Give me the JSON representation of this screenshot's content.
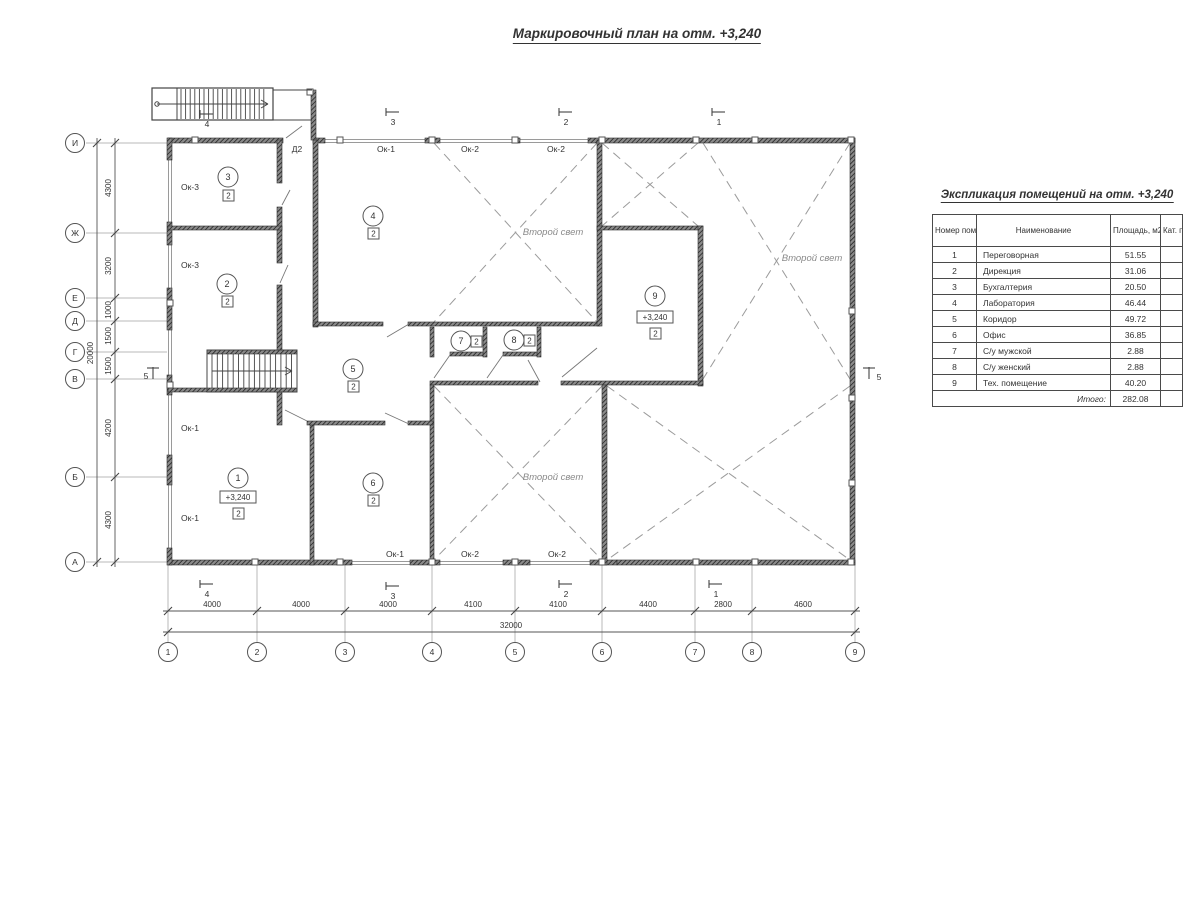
{
  "title": "Маркировочный план на отм. +3,240",
  "table": {
    "title": "Экспликация помещений на отм. +3,240",
    "headers": {
      "num": "Номер помещ.",
      "name": "Наименование",
      "area": "Площадь, м2",
      "cat": "Кат. пом."
    },
    "col_widths": [
      44,
      134,
      50,
      22
    ],
    "rows": [
      {
        "num": "1",
        "name": "Переговорная",
        "area": "51.55",
        "cat": ""
      },
      {
        "num": "2",
        "name": "Дирекция",
        "area": "31.06",
        "cat": ""
      },
      {
        "num": "3",
        "name": "Бухгалтерия",
        "area": "20.50",
        "cat": ""
      },
      {
        "num": "4",
        "name": "Лаборатория",
        "area": "46.44",
        "cat": ""
      },
      {
        "num": "5",
        "name": "Коридор",
        "area": "49.72",
        "cat": ""
      },
      {
        "num": "6",
        "name": "Офис",
        "area": "36.85",
        "cat": ""
      },
      {
        "num": "7",
        "name": "С/у мужской",
        "area": "2.88",
        "cat": ""
      },
      {
        "num": "8",
        "name": "С/у женский",
        "area": "2.88",
        "cat": ""
      },
      {
        "num": "9",
        "name": "Тех. помещение",
        "area": "40.20",
        "cat": ""
      }
    ],
    "total_label": "Итого:",
    "total_value": "282.08"
  },
  "plan": {
    "colors": {
      "line": "#3d3d3d",
      "grid": "#b9b9b9",
      "dash": "#9b9b9b",
      "wall_dark": "#2f2f2f",
      "wall_mid": "#8a8a8a",
      "window": "#9a9a9a",
      "text": "#333333",
      "svet_text": "#8a8a8a"
    },
    "axis_rows": [
      {
        "label": "И",
        "y": 143
      },
      {
        "label": "Ж",
        "y": 233
      },
      {
        "label": "Е",
        "y": 298
      },
      {
        "label": "Д",
        "y": 321
      },
      {
        "label": "Г",
        "y": 352
      },
      {
        "label": "В",
        "y": 379
      },
      {
        "label": "Б",
        "y": 477
      },
      {
        "label": "А",
        "y": 562
      }
    ],
    "dims_v": [
      {
        "text": "4300",
        "y": 188
      },
      {
        "text": "3200",
        "y": 266
      },
      {
        "text": "1000",
        "y": 310
      },
      {
        "text": "1500",
        "y": 336
      },
      {
        "text": "1500",
        "y": 366
      },
      {
        "text": "4200",
        "y": 428
      },
      {
        "text": "4300",
        "y": 520
      }
    ],
    "total_v": {
      "text": "20000",
      "x": 93,
      "y": 353
    },
    "axis_cols": [
      {
        "label": "1",
        "x": 168
      },
      {
        "label": "2",
        "x": 257
      },
      {
        "label": "3",
        "x": 345
      },
      {
        "label": "4",
        "x": 432
      },
      {
        "label": "5",
        "x": 515
      },
      {
        "label": "6",
        "x": 602
      },
      {
        "label": "7",
        "x": 695
      },
      {
        "label": "8",
        "x": 752
      },
      {
        "label": "9",
        "x": 855
      }
    ],
    "dims_h": [
      {
        "text": "4000",
        "x": 212
      },
      {
        "text": "4000",
        "x": 301
      },
      {
        "text": "4000",
        "x": 388
      },
      {
        "text": "4100",
        "x": 473
      },
      {
        "text": "4100",
        "x": 558
      },
      {
        "text": "4400",
        "x": 648
      },
      {
        "text": "2800",
        "x": 723
      },
      {
        "text": "4600",
        "x": 803
      }
    ],
    "total_h": {
      "text": "32000",
      "x": 511,
      "y": 628
    },
    "walls": [
      [
        168,
        138,
        115,
        5
      ],
      [
        313,
        138,
        12,
        5
      ],
      [
        425,
        138,
        15,
        5
      ],
      [
        512,
        138,
        8,
        5
      ],
      [
        588,
        138,
        267,
        5
      ],
      [
        168,
        560,
        184,
        5
      ],
      [
        410,
        560,
        30,
        5
      ],
      [
        503,
        560,
        27,
        5
      ],
      [
        590,
        560,
        27,
        5
      ],
      [
        617,
        560,
        238,
        5
      ],
      [
        167,
        138,
        5,
        22
      ],
      [
        167,
        222,
        5,
        23
      ],
      [
        167,
        288,
        5,
        42
      ],
      [
        167,
        375,
        5,
        20
      ],
      [
        167,
        455,
        5,
        30
      ],
      [
        167,
        548,
        5,
        17
      ],
      [
        850,
        138,
        5,
        427
      ],
      [
        277,
        140,
        5,
        43
      ],
      [
        277,
        207,
        5,
        56
      ],
      [
        277,
        285,
        5,
        67
      ],
      [
        277,
        392,
        5,
        33
      ],
      [
        168,
        226,
        114,
        4
      ],
      [
        313,
        140,
        5,
        187
      ],
      [
        313,
        322,
        70,
        4
      ],
      [
        408,
        322,
        192,
        4
      ],
      [
        597,
        140,
        5,
        186
      ],
      [
        597,
        226,
        106,
        4
      ],
      [
        698,
        226,
        5,
        160
      ],
      [
        430,
        381,
        108,
        4
      ],
      [
        561,
        381,
        142,
        4
      ],
      [
        602,
        385,
        5,
        180
      ],
      [
        430,
        385,
        4,
        180
      ],
      [
        430,
        327,
        4,
        30
      ],
      [
        483,
        327,
        4,
        30
      ],
      [
        537,
        327,
        4,
        30
      ],
      [
        450,
        352,
        33,
        4
      ],
      [
        503,
        352,
        34,
        4
      ],
      [
        310,
        425,
        4,
        140
      ],
      [
        307,
        421,
        78,
        4
      ],
      [
        408,
        421,
        25,
        4
      ],
      [
        168,
        388,
        39,
        4
      ],
      [
        311,
        90,
        5,
        50
      ],
      [
        207,
        350,
        90,
        4
      ],
      [
        207,
        388,
        90,
        4
      ]
    ],
    "windows_h": [
      [
        325,
        139,
        100
      ],
      [
        440,
        139,
        72
      ],
      [
        520,
        139,
        68
      ],
      [
        352,
        561,
        58
      ],
      [
        440,
        561,
        63
      ],
      [
        530,
        561,
        60
      ]
    ],
    "windows_v": [
      [
        168,
        160,
        62
      ],
      [
        168,
        245,
        43
      ],
      [
        168,
        330,
        45
      ],
      [
        168,
        395,
        60
      ],
      [
        168,
        485,
        63
      ]
    ],
    "ticks": [
      [
        195,
        140
      ],
      [
        340,
        140
      ],
      [
        432,
        140
      ],
      [
        515,
        140
      ],
      [
        602,
        140
      ],
      [
        696,
        140
      ],
      [
        755,
        140
      ],
      [
        851,
        140
      ],
      [
        255,
        562
      ],
      [
        340,
        562
      ],
      [
        432,
        562
      ],
      [
        515,
        562
      ],
      [
        602,
        562
      ],
      [
        696,
        562
      ],
      [
        755,
        562
      ],
      [
        851,
        562
      ],
      [
        170,
        303
      ],
      [
        170,
        385
      ],
      [
        852,
        311
      ],
      [
        852,
        398
      ],
      [
        852,
        483
      ],
      [
        310,
        92
      ]
    ],
    "crosses": [
      [
        434,
        143,
        597,
        322
      ],
      [
        602,
        143,
        698,
        226
      ],
      [
        703,
        143,
        850,
        379
      ],
      [
        607,
        386,
        850,
        560
      ],
      [
        434,
        386,
        602,
        560
      ]
    ],
    "svet_labels": [
      {
        "text": "Второй свет",
        "x": 553,
        "y": 235
      },
      {
        "text": "Второй свет",
        "x": 812,
        "y": 261
      },
      {
        "text": "Второй свет",
        "x": 553,
        "y": 480
      }
    ],
    "door_leaves": [
      [
        286,
        138,
        302,
        126
      ],
      [
        282,
        205,
        290,
        190
      ],
      [
        280,
        283,
        288,
        265
      ],
      [
        387,
        337,
        409,
        324
      ],
      [
        285,
        410,
        307,
        421
      ],
      [
        385,
        413,
        409,
        424
      ],
      [
        528,
        360,
        540,
        382
      ],
      [
        562,
        377,
        597,
        348
      ],
      [
        450,
        355,
        434,
        378
      ],
      [
        503,
        355,
        487,
        378
      ]
    ],
    "rooms": [
      {
        "n": "1",
        "cx": 238,
        "cy": 478,
        "sq": [
          233,
          508
        ],
        "elev": "+3,240",
        "ex": 238,
        "ey": 497
      },
      {
        "n": "2",
        "cx": 227,
        "cy": 284,
        "sq": [
          222,
          296
        ]
      },
      {
        "n": "3",
        "cx": 228,
        "cy": 177,
        "sq": [
          223,
          190
        ]
      },
      {
        "n": "4",
        "cx": 373,
        "cy": 216,
        "sq": [
          368,
          228
        ]
      },
      {
        "n": "5",
        "cx": 353,
        "cy": 369,
        "sq": [
          348,
          381
        ]
      },
      {
        "n": "6",
        "cx": 373,
        "cy": 483,
        "sq": [
          368,
          495
        ]
      },
      {
        "n": "7",
        "cx": 461,
        "cy": 341,
        "sq": [
          471,
          336
        ]
      },
      {
        "n": "8",
        "cx": 514,
        "cy": 340,
        "sq": [
          524,
          335
        ]
      },
      {
        "n": "9",
        "cx": 655,
        "cy": 296,
        "sq": [
          650,
          328
        ],
        "elev": "+3,240",
        "ex": 655,
        "ey": 317
      }
    ],
    "opening_labels": [
      {
        "text": "Ок-3",
        "x": 190,
        "y": 190
      },
      {
        "text": "Ок-3",
        "x": 190,
        "y": 268
      },
      {
        "text": "Ок-1",
        "x": 190,
        "y": 431
      },
      {
        "text": "Ок-1",
        "x": 190,
        "y": 521
      },
      {
        "text": "Д2",
        "x": 297,
        "y": 152
      },
      {
        "text": "Ок-1",
        "x": 386,
        "y": 152
      },
      {
        "text": "Ок-2",
        "x": 470,
        "y": 152
      },
      {
        "text": "Ок-2",
        "x": 556,
        "y": 152
      },
      {
        "text": "Ок-1",
        "x": 395,
        "y": 557
      },
      {
        "text": "Ок-2",
        "x": 470,
        "y": 557
      },
      {
        "text": "Ок-2",
        "x": 557,
        "y": 557
      }
    ],
    "section_marks_h": [
      {
        "n": "4",
        "x": 200,
        "y": 116
      },
      {
        "n": "3",
        "x": 386,
        "y": 114
      },
      {
        "n": "2",
        "x": 559,
        "y": 114
      },
      {
        "n": "1",
        "x": 712,
        "y": 114
      },
      {
        "n": "4",
        "x": 200,
        "y": 586
      },
      {
        "n": "3",
        "x": 386,
        "y": 588
      },
      {
        "n": "2",
        "x": 559,
        "y": 586
      },
      {
        "n": "1",
        "x": 709,
        "y": 586
      }
    ],
    "section_marks_v": [
      {
        "n": "5",
        "x": 152,
        "y": 371,
        "side": "left"
      },
      {
        "n": "5",
        "x": 868,
        "y": 371,
        "side": "right"
      }
    ],
    "stair_ext": {
      "x": 152,
      "y": 88,
      "w": 121,
      "h": 32,
      "landing_w": 25,
      "bridge_x2": 312
    },
    "stair_int": {
      "x": 207,
      "y": 350,
      "w": 90,
      "h": 42
    }
  }
}
